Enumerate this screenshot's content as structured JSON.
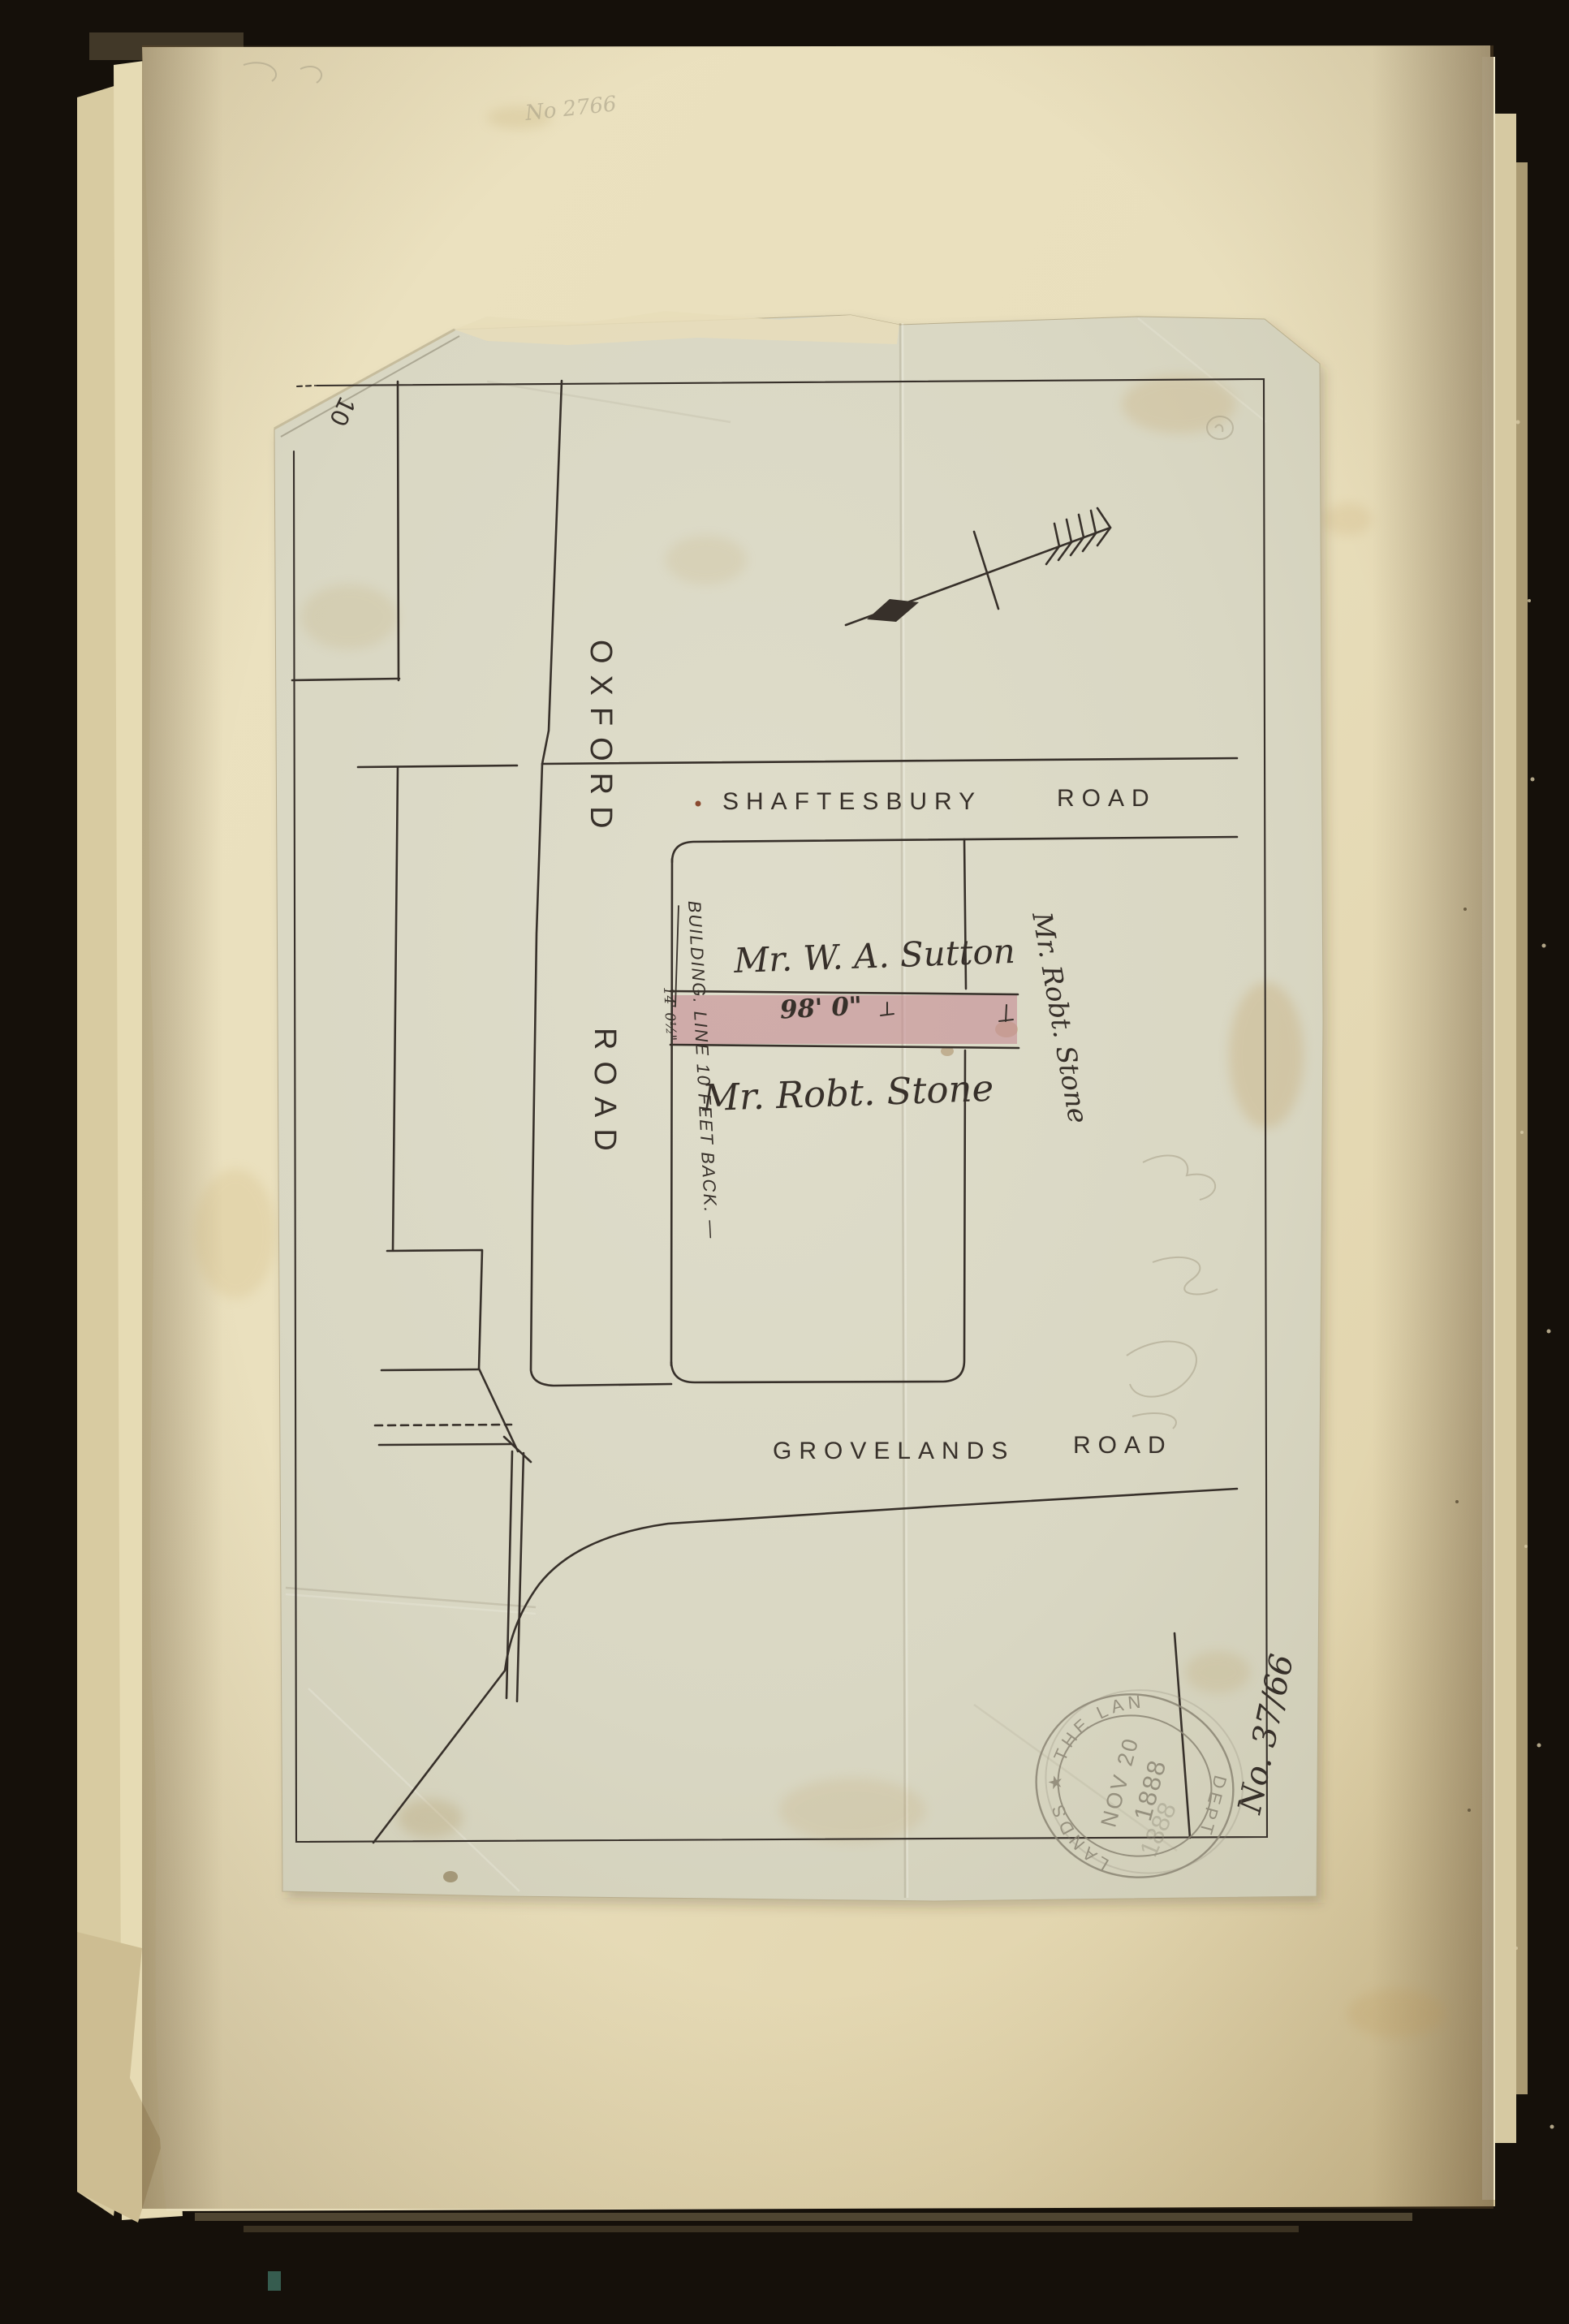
{
  "plan": {
    "corner_mark": "10",
    "pencil_note": "No 2766",
    "file_number": "No. 37/66",
    "roads": {
      "oxford_word1": "OXFORD",
      "oxford_word2": "ROAD",
      "shaftesbury_word1": "SHAFTESBURY",
      "shaftesbury_word2": "ROAD",
      "grovelands_word1": "GROVELANDS",
      "grovelands_word2": "ROAD"
    },
    "owners": {
      "north_plot": "Mr. W. A. Sutton",
      "south_plot": "Mr. Robt. Stone",
      "east_plot": "Mr. Robt. Stone"
    },
    "strip": {
      "length": "98' 0\"",
      "width": "14' 0½\""
    },
    "building_line": {
      "word1": "BUILDING.",
      "rest": "LINE 10 FEET BACK. —"
    },
    "stamp": {
      "arc_top": "LANDS ★ THE LAN",
      "arc_bottom": "DEPT",
      "date_line1": "NOV 20",
      "date_line2": "1888",
      "date_ghost": "1888"
    },
    "colors": {
      "ink": "#37302a",
      "pink_strip": "#c2848e",
      "stamp_grey": "#8b8574",
      "pencil": "#a29a82",
      "page_cream": "#e9dfbd",
      "linen": "#d9d7c3",
      "background": "#15100a"
    }
  }
}
